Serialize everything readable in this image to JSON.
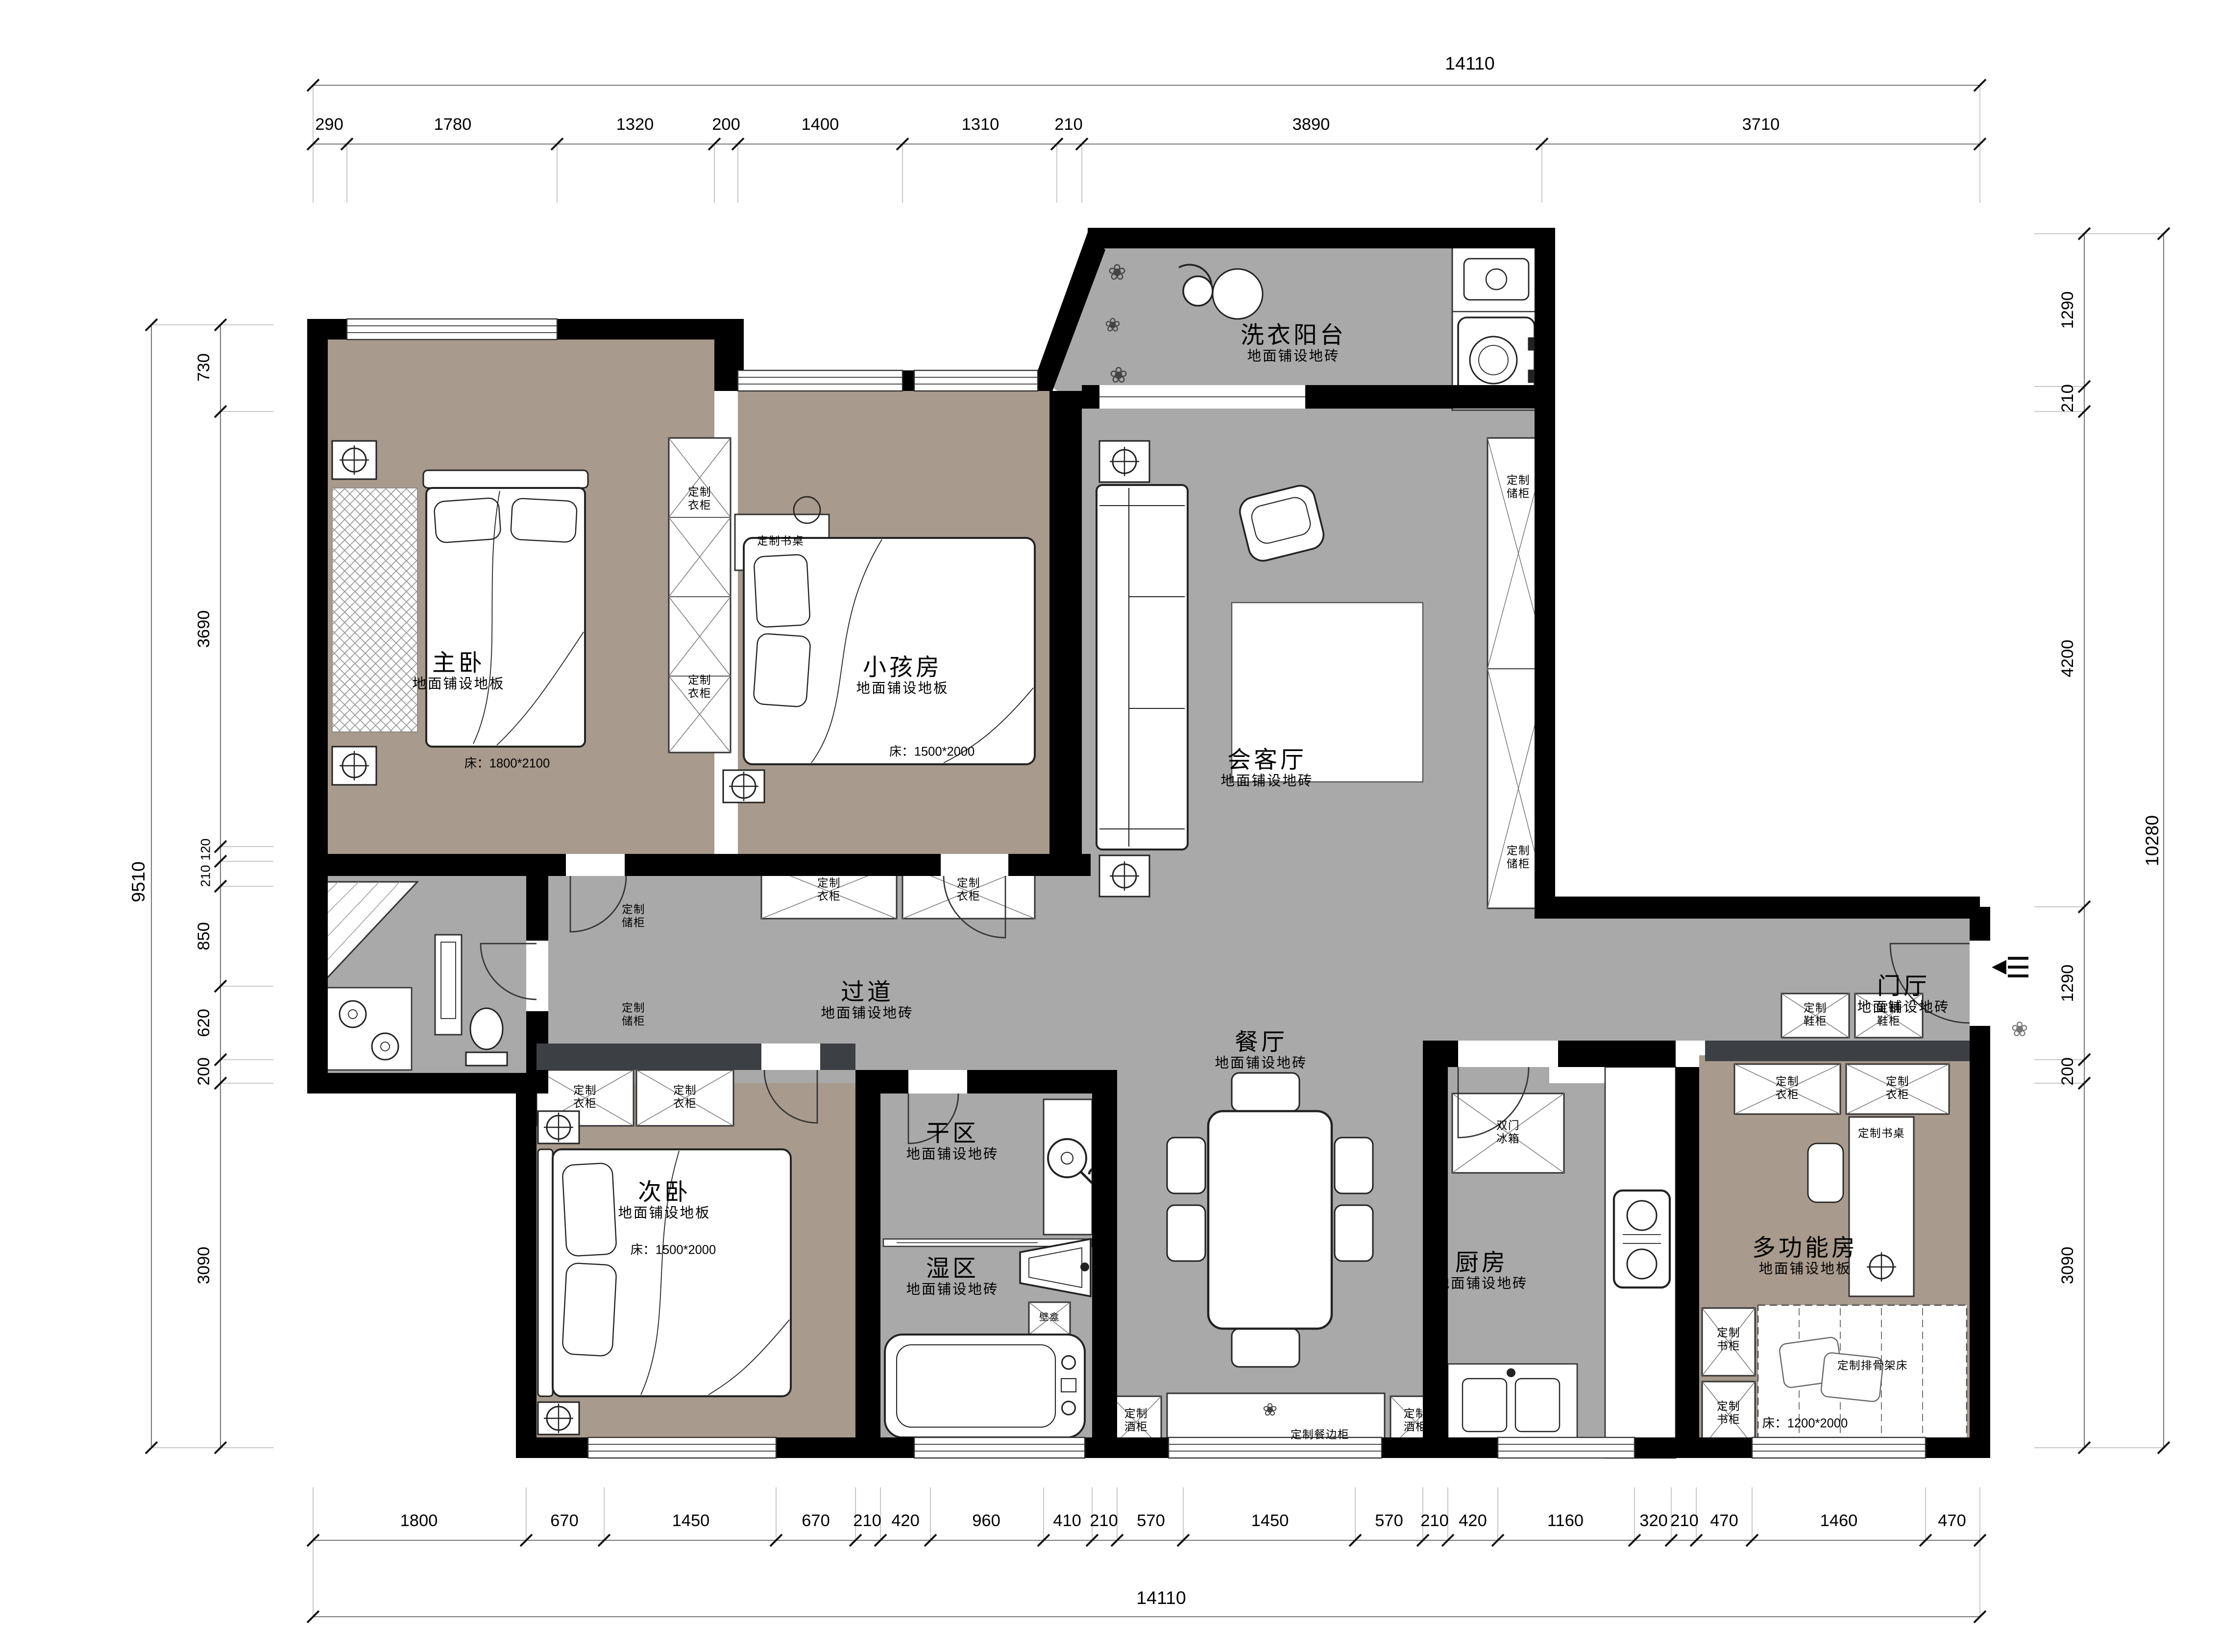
{
  "plan_title": "apartment-floor-plan",
  "dims": {
    "top": {
      "total": "14110",
      "segments": [
        "290",
        "1780",
        "1320",
        "200",
        "1400",
        "1310",
        "210",
        "3890",
        "3710"
      ]
    },
    "bottom": {
      "total": "14110",
      "segments": [
        "1800",
        "670",
        "1450",
        "670",
        "210",
        "420",
        "960",
        "410",
        "210",
        "570",
        "1450",
        "570",
        "210",
        "420",
        "1160",
        "320",
        "210",
        "470",
        "1460",
        "470"
      ]
    },
    "left": {
      "total": "9510",
      "segments": [
        "730",
        "3690",
        "120",
        "210",
        "850",
        "620",
        "200",
        "3090"
      ]
    },
    "right": {
      "total": "10280",
      "segments": [
        "1290",
        "210",
        "4200",
        "1290",
        "200",
        "3090"
      ]
    }
  },
  "rooms": {
    "master": {
      "name": "主卧",
      "floor": "地面铺设地板",
      "bed": "床：1800*2100"
    },
    "kids": {
      "name": "小孩房",
      "floor": "地面铺设地板",
      "bed": "床：1500*2000"
    },
    "laundry": {
      "name": "洗衣阳台",
      "floor": "地面铺设地砖"
    },
    "living": {
      "name": "会客厅",
      "floor": "地面铺设地砖"
    },
    "hallway": {
      "name": "过道",
      "floor": "地面铺设地砖"
    },
    "dining": {
      "name": "餐厅",
      "floor": "地面铺设地砖"
    },
    "dry": {
      "name": "干区",
      "floor": "地面铺设地砖"
    },
    "wet": {
      "name": "湿区",
      "floor": "地面铺设地砖"
    },
    "second": {
      "name": "次卧",
      "floor": "地面铺设地板",
      "bed": "床：1500*2000"
    },
    "kitchen": {
      "name": "厨房",
      "floor": "地面铺设地砖"
    },
    "foyer": {
      "name": "门厅",
      "floor": "地面铺设地砖"
    },
    "multi": {
      "name": "多功能房",
      "floor": "地面铺设地板",
      "bed": "床：1200*2000"
    }
  },
  "cabinets": {
    "wardrobe": "定制衣柜",
    "storage": "定制储柜",
    "shoe": "定制鞋柜",
    "desk": "定制书桌",
    "bookcase": "定制书柜",
    "wine": "定制酒柜",
    "sideboard": "定制餐边柜",
    "fridge": "双门冰箱",
    "slat_bed": "定制排骨架床",
    "niche": "壁龛"
  },
  "icons": {
    "plant": "❀",
    "entry_arrow": "◀"
  },
  "colors": {
    "wall": "#000000",
    "tile": "#a9a9a9",
    "wood": "#a89a8c",
    "dark_band": "#3c4045",
    "paper": "#ffffff"
  }
}
